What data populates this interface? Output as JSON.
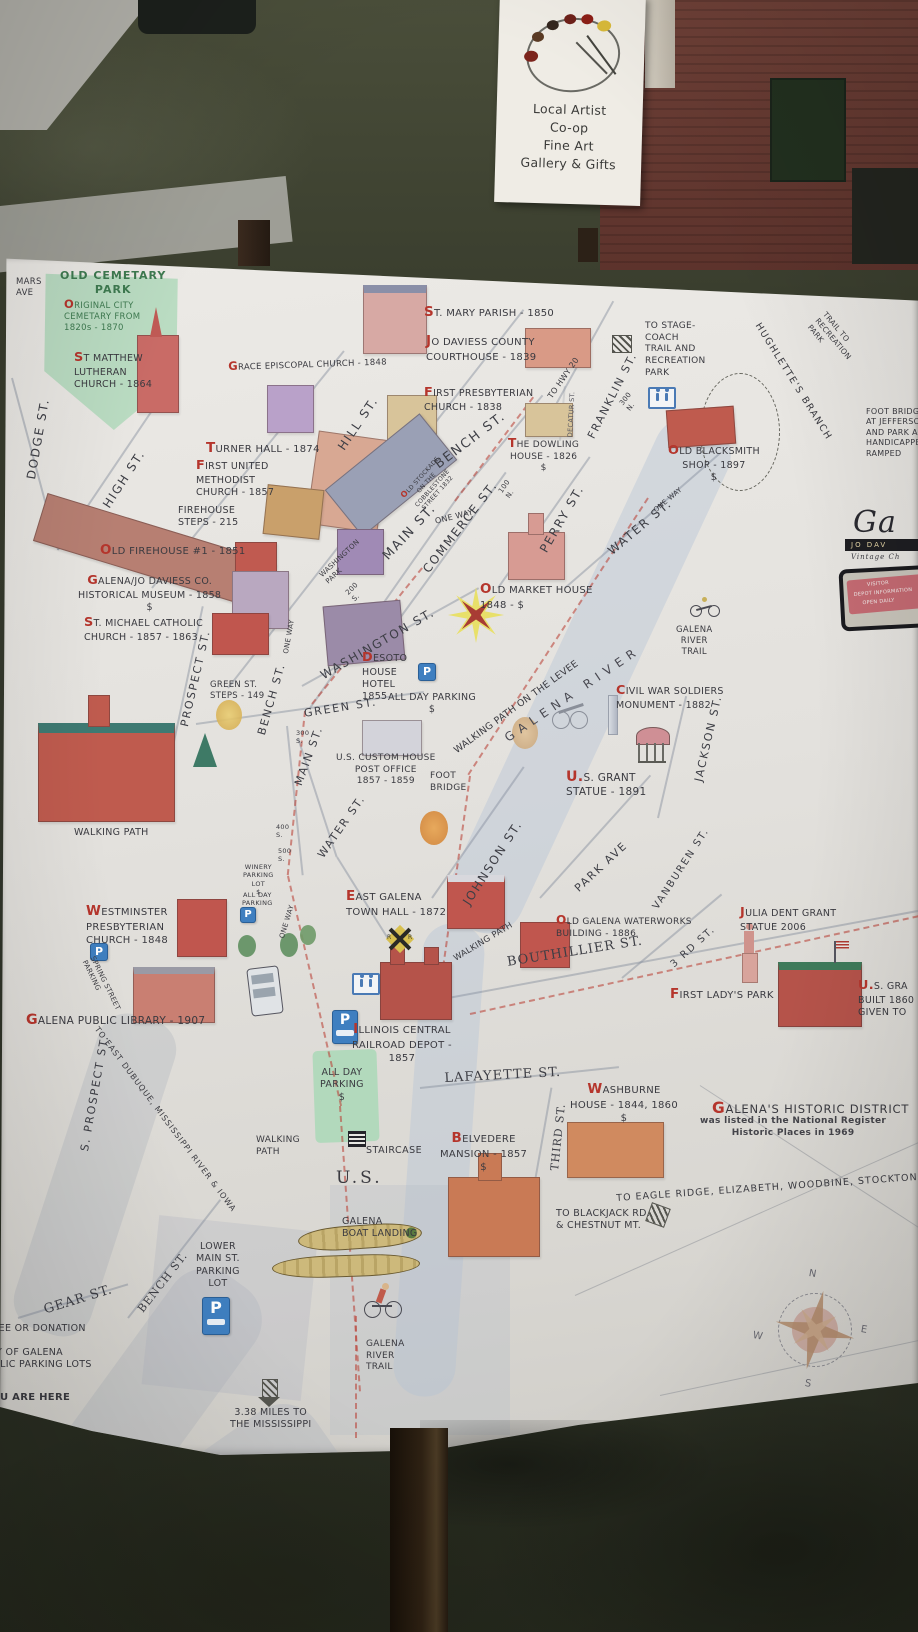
{
  "scene": {
    "artist_sign": {
      "lines": [
        "Local Artist",
        "Co-op",
        "Fine Art",
        "Gallery & Gifts"
      ]
    }
  },
  "map": {
    "labels": {
      "mars_ave": "MARS\nAVE",
      "cemetery_title": "OLD CEMETARY\nPARK",
      "cemetery_sub": "ORIGINAL CITY\nCEMETARY FROM\n1820s - 1870",
      "st_matthew": "ST MATTHEW\nLUTHERAN\nCHURCH - 1864",
      "dodge_st": "DODGE ST.",
      "high_st": "HIGH ST.",
      "grace_episcopal": "GRACE EPISCOPAL CHURCH - 1848",
      "turner_hall": "TURNER HALL - 1874",
      "first_methodist": "FIRST UNITED\nMETHODIST\nCHURCH - 1857",
      "firehouse_steps": "FIREHOUSE\nSTEPS - 215",
      "old_firehouse": "OLD FIREHOUSE #1 - 1851",
      "historical_museum": "GALENA/JO DAVIESS CO.\nHISTORICAL MUSEUM - 1858\n$",
      "st_michael": "ST. MICHAEL CATHOLIC\nCHURCH - 1857 - 1863",
      "st_mary": "ST. MARY PARISH - 1850",
      "courthouse": "JO DAVIESS COUNTY\nCOURTHOUSE - 1839",
      "first_presbyterian": "FIRST PRESBYTERIAN\nCHURCH - 1838",
      "dowling": "THE DOWLING\nHOUSE - 1826\n$",
      "hill_st": "HILL ST.",
      "bench_st": "BENCH ST.",
      "franklin_st": "FRANKLIN ST.",
      "to_hwy_20": "TO HWY 20",
      "decatur_st": "DECATUR ST.",
      "n_300": "300\nN.",
      "n_100": "100\nN.",
      "s_200": "200\nS.",
      "s_300": "300\nS.",
      "s_400": "400\nS.",
      "s_500": "500\nS.",
      "stagecoach": "TO STAGE-\nCOACH\nTRAIL AND\nRECREATION\nPARK",
      "hughlettes": "HUGHLETTE'S BRANCH",
      "trail_rec": "TRAIL TO\nRECREATION\nPARK",
      "foot_bridge_note": "FOOT BRIDGE\nAT JEFFERSON\nAND PARK A\nHANDICAPPED\nRAMPED",
      "blacksmith": "OLD BLACKSMITH\nSHOP - 1897\n$",
      "stockade": "OLD STOCKADE\nON THE\nCOBBLESTONE\nSTREET 1832",
      "one_way": "ONE WAY",
      "main_st": "MAIN ST.",
      "commerce_st": "COMMERCE ST.",
      "perry_st": "PERRY ST.",
      "water_st": "WATER ST.",
      "market_house": "OLD MARKET HOUSE\n1848 - $",
      "washington_st": "WASHINGTON ST.",
      "washington_park": "WASHINGTON\nPARK",
      "desoto": "DESOTO\nHOUSE\nHOTEL\n1855",
      "all_day_parking": "ALL DAY PARKING\n$",
      "all_day_parking_3l": "ALL DAY\nPARKING\n$",
      "green_steps": "GREEN ST.\nSTEPS - 149",
      "green_st": "GREEN ST.",
      "prospect_st": "PROSPECT ST.",
      "custom_house": "U.S. CUSTOM HOUSE\nPOST OFFICE\n1857 - 1859",
      "foot_bridge": "FOOT\nBRIDGE",
      "levee_path": "WALKING PATH ON THE LEVEE",
      "galena_river": "GALENA RIVER",
      "river_trail": "GALENA\nRIVER\nTRAIL",
      "civil_war": "CIVIL WAR SOLDIERS\nMONUMENT - 1882",
      "grant_statue": "U.S. GRANT\nSTATUE - 1891",
      "jackson_st": "JACKSON ST.",
      "park_ave": "PARK AVE",
      "vanburen_st": "VANBUREN ST.",
      "johnson_st": "JOHNSON ST.",
      "town_hall": "EAST GALENA\nTOWN HALL - 1872",
      "walking_path": "WALKING PATH",
      "walking_path_2l": "WALKING\nPATH",
      "waterworks": "OLD GALENA WATERWORKS\nBUILDING - 1886",
      "third_rd_st": "3 RD ST.",
      "julia": "JULIA DENT GRANT\nSTATUE 2006",
      "first_lady": "FIRST LADY'S PARK",
      "grant_home": "U.S. GRA\nBUILT 1860\nGIVEN TO",
      "westminster": "WESTMINSTER\nPRESBYTERIAN\nCHURCH - 1848",
      "library": "GALENA PUBLIC LIBRARY - 1907",
      "spring_parking": "SPRING STREET\nPARKING",
      "winery": "WINERY\nPARKING\nLOT\n$",
      "all_day_small": "ALL DAY\nPARKING",
      "to_dubuque": "TO EAST DUBUQUE, MISSISSIPPI RIVER & IOWA",
      "s_prospect_st": "S. PROSPECT ST.",
      "bouthillier_st": "BOUTHILLIER ST.",
      "depot": "ILLINOIS CENTRAL\nRAILROAD DEPOT -\n1857",
      "lafayette_st": "LAFAYETTE ST.",
      "washburne": "WASHBURNE\nHOUSE - 1844, 1860\n$",
      "third_st": "THIRD ST.",
      "historic_district": "GALENA'S HISTORIC DISTRICT",
      "historic_district_sub": "was listed in the National Register\nHistoric Places in 1969",
      "belvedere": "BELVEDERE\nMANSION - 1857\n$",
      "eagle_ridge": "TO EAGLE RIDGE, ELIZABETH, WOODBINE, STOCKTON",
      "blackjack": "TO BLACKJACK RD.\n& CHESTNUT MT.",
      "us_hwy": "U.S.",
      "boat_landing": "GALENA\nBOAT LANDING",
      "lower_main": "LOWER\nMAIN ST.\nPARKING\nLOT",
      "gear_st": "GEAR ST.",
      "free_donation": "FREE OR DONATION",
      "city_lots": "CITY OF GALENA\nPUBLIC PARKING LOTS",
      "you_are_here": "YOU ARE HERE",
      "miles": "3.38 MILES TO\nTHE MISSISSIPPI"
    },
    "icons": {
      "p": "P",
      "rr": "R"
    },
    "compass": {
      "n": "N",
      "e": "E",
      "s": "S",
      "w": "W"
    },
    "logo": {
      "script": "Ga",
      "band": "JO DAV",
      "tagline": "Vintage Ch"
    },
    "sticker": {
      "lines": [
        "VISITOR",
        "DEPOT INFORMATION",
        "OPEN DAILY"
      ]
    },
    "colors": {
      "board": "#e8e6e2",
      "park_green": "#b2d9bc",
      "parking_blue": "#3f7fc0",
      "accent_red": "#b5352c",
      "river": "#b8c6d6"
    }
  }
}
